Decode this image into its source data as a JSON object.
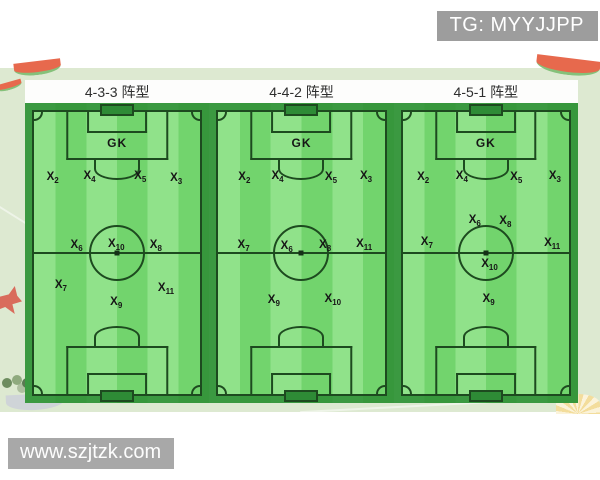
{
  "page": {
    "tg_badge": "TG: MYYJJPP",
    "watermark": "www.szjtzk.com"
  },
  "colors": {
    "stripe_light": "#90e28a",
    "stripe_dark": "#72d46d",
    "pitch_line": "#1d4a1f",
    "panel_background": "#dde9d1",
    "badge_background": "#9d9d9d",
    "watermark_background": "#a8a8a8"
  },
  "decorations": [
    "watermelon-slice-top-left",
    "watermelon-slice-top-left-small",
    "watermelon-slice-top-right",
    "coral-left",
    "plant-bottom-left",
    "paper-boat-bottom-left",
    "flower-bottom-right"
  ],
  "formations": [
    {
      "title": "4-3-3 阵型",
      "gk_label": "GK",
      "players": [
        {
          "base": "X",
          "sub": "2",
          "x": 15,
          "y": 25
        },
        {
          "base": "X",
          "sub": "4",
          "x": 35,
          "y": 24.8
        },
        {
          "base": "X",
          "sub": "5",
          "x": 62.5,
          "y": 24.5
        },
        {
          "base": "X",
          "sub": "3",
          "x": 82,
          "y": 25.2
        },
        {
          "base": "X",
          "sub": "6",
          "x": 28,
          "y": 47.7
        },
        {
          "base": "X",
          "sub": "10",
          "x": 49.5,
          "y": 47.3
        },
        {
          "base": "X",
          "sub": "8",
          "x": 71,
          "y": 47.7
        },
        {
          "base": "X",
          "sub": "7",
          "x": 19.5,
          "y": 61
        },
        {
          "base": "X",
          "sub": "11",
          "x": 76.5,
          "y": 62
        },
        {
          "base": "X",
          "sub": "9",
          "x": 49.5,
          "y": 66.5
        }
      ]
    },
    {
      "title": "4-4-2 阵型",
      "gk_label": "GK",
      "players": [
        {
          "base": "X",
          "sub": "2",
          "x": 19,
          "y": 25
        },
        {
          "base": "X",
          "sub": "4",
          "x": 37,
          "y": 24.6
        },
        {
          "base": "X",
          "sub": "5",
          "x": 66,
          "y": 25
        },
        {
          "base": "X",
          "sub": "3",
          "x": 85,
          "y": 24.6
        },
        {
          "base": "X",
          "sub": "7",
          "x": 18.6,
          "y": 47.7
        },
        {
          "base": "X",
          "sub": "6",
          "x": 42,
          "y": 48
        },
        {
          "base": "X",
          "sub": "8",
          "x": 62.8,
          "y": 47.7
        },
        {
          "base": "X",
          "sub": "11",
          "x": 84,
          "y": 47.4
        },
        {
          "base": "X",
          "sub": "9",
          "x": 35,
          "y": 66
        },
        {
          "base": "X",
          "sub": "10",
          "x": 67,
          "y": 65.6
        }
      ]
    },
    {
      "title": "4-5-1 阵型",
      "gk_label": "GK",
      "players": [
        {
          "base": "X",
          "sub": "2",
          "x": 16,
          "y": 25
        },
        {
          "base": "X",
          "sub": "4",
          "x": 37,
          "y": 24.6
        },
        {
          "base": "X",
          "sub": "5",
          "x": 66.5,
          "y": 25
        },
        {
          "base": "X",
          "sub": "3",
          "x": 87.5,
          "y": 24.6
        },
        {
          "base": "X",
          "sub": "6",
          "x": 44,
          "y": 39.4
        },
        {
          "base": "X",
          "sub": "8",
          "x": 60.6,
          "y": 39.6
        },
        {
          "base": "X",
          "sub": "7",
          "x": 18,
          "y": 46.8
        },
        {
          "base": "X",
          "sub": "11",
          "x": 86,
          "y": 47
        },
        {
          "base": "X",
          "sub": "10",
          "x": 52,
          "y": 54
        },
        {
          "base": "X",
          "sub": "9",
          "x": 51.5,
          "y": 65.6
        }
      ]
    }
  ]
}
